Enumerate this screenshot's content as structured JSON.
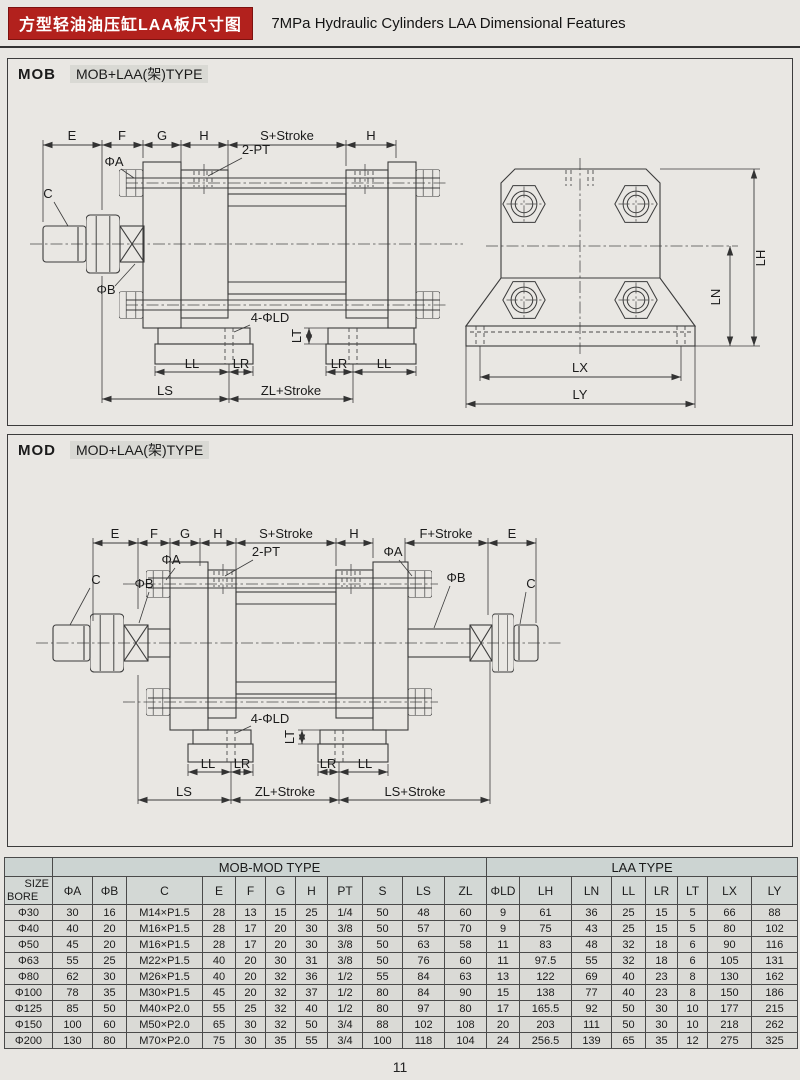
{
  "page": {
    "title_cn": "方型轻油油压缸LAA板尺寸图",
    "title_en": "7MPa Hydraulic Cylinders LAA Dimensional Features",
    "page_number": "11",
    "accent_red": "#b2211d"
  },
  "sections": {
    "mob": {
      "tag": "MOB",
      "title": "MOB+LAA(架)TYPE"
    },
    "mod": {
      "tag": "MOD",
      "title": "MOD+LAA(架)TYPE"
    }
  },
  "labels": {
    "e": "E",
    "f": "F",
    "g": "G",
    "h": "H",
    "s_stroke": "S+Stroke",
    "f_stroke": "F+Stroke",
    "c": "C",
    "phi_a": "ΦA",
    "phi_b": "ΦB",
    "port2pt": "2-PT",
    "holes4": "4-ΦLD",
    "lt": "LT",
    "ll": "LL",
    "lr": "LR",
    "ls": "LS",
    "zl_stroke": "ZL+Stroke",
    "ls_stroke": "LS+Stroke",
    "lh": "LH",
    "ln": "LN",
    "lx": "LX",
    "ly": "LY"
  },
  "table": {
    "group_headers": [
      "MOB-MOD TYPE",
      "LAA TYPE"
    ],
    "corner": {
      "top": "SIZE",
      "bottom": "BORE"
    },
    "columns": [
      "ΦA",
      "ΦB",
      "C",
      "E",
      "F",
      "G",
      "H",
      "PT",
      "S",
      "LS",
      "ZL",
      "ΦLD",
      "LH",
      "LN",
      "LL",
      "LR",
      "LT",
      "LX",
      "LY"
    ],
    "rows": [
      {
        "bore": "Φ30",
        "values": [
          "30",
          "16",
          "M14×P1.5",
          "28",
          "13",
          "15",
          "25",
          "1/4",
          "50",
          "48",
          "60",
          "9",
          "61",
          "36",
          "25",
          "15",
          "5",
          "66",
          "88"
        ]
      },
      {
        "bore": "Φ40",
        "values": [
          "40",
          "20",
          "M16×P1.5",
          "28",
          "17",
          "20",
          "30",
          "3/8",
          "50",
          "57",
          "70",
          "9",
          "75",
          "43",
          "25",
          "15",
          "5",
          "80",
          "102"
        ]
      },
      {
        "bore": "Φ50",
        "values": [
          "45",
          "20",
          "M16×P1.5",
          "28",
          "17",
          "20",
          "30",
          "3/8",
          "50",
          "63",
          "58",
          "11",
          "83",
          "48",
          "32",
          "18",
          "6",
          "90",
          "116"
        ]
      },
      {
        "bore": "Φ63",
        "values": [
          "55",
          "25",
          "M22×P1.5",
          "40",
          "20",
          "30",
          "31",
          "3/8",
          "50",
          "76",
          "60",
          "11",
          "97.5",
          "55",
          "32",
          "18",
          "6",
          "105",
          "131"
        ]
      },
      {
        "bore": "Φ80",
        "values": [
          "62",
          "30",
          "M26×P1.5",
          "40",
          "20",
          "32",
          "36",
          "1/2",
          "55",
          "84",
          "63",
          "13",
          "122",
          "69",
          "40",
          "23",
          "8",
          "130",
          "162"
        ]
      },
      {
        "bore": "Φ100",
        "values": [
          "78",
          "35",
          "M30×P1.5",
          "45",
          "20",
          "32",
          "37",
          "1/2",
          "80",
          "84",
          "90",
          "15",
          "138",
          "77",
          "40",
          "23",
          "8",
          "150",
          "186"
        ]
      },
      {
        "bore": "Φ125",
        "values": [
          "85",
          "50",
          "M40×P2.0",
          "55",
          "25",
          "32",
          "40",
          "1/2",
          "80",
          "97",
          "80",
          "17",
          "165.5",
          "92",
          "50",
          "30",
          "10",
          "177",
          "215"
        ]
      },
      {
        "bore": "Φ150",
        "values": [
          "100",
          "60",
          "M50×P2.0",
          "65",
          "30",
          "32",
          "50",
          "3/4",
          "88",
          "102",
          "108",
          "20",
          "203",
          "111",
          "50",
          "30",
          "10",
          "218",
          "262"
        ]
      },
      {
        "bore": "Φ200",
        "values": [
          "130",
          "80",
          "M70×P2.0",
          "75",
          "30",
          "35",
          "55",
          "3/4",
          "100",
          "118",
          "104",
          "24",
          "256.5",
          "139",
          "65",
          "35",
          "12",
          "275",
          "325"
        ]
      }
    ]
  }
}
